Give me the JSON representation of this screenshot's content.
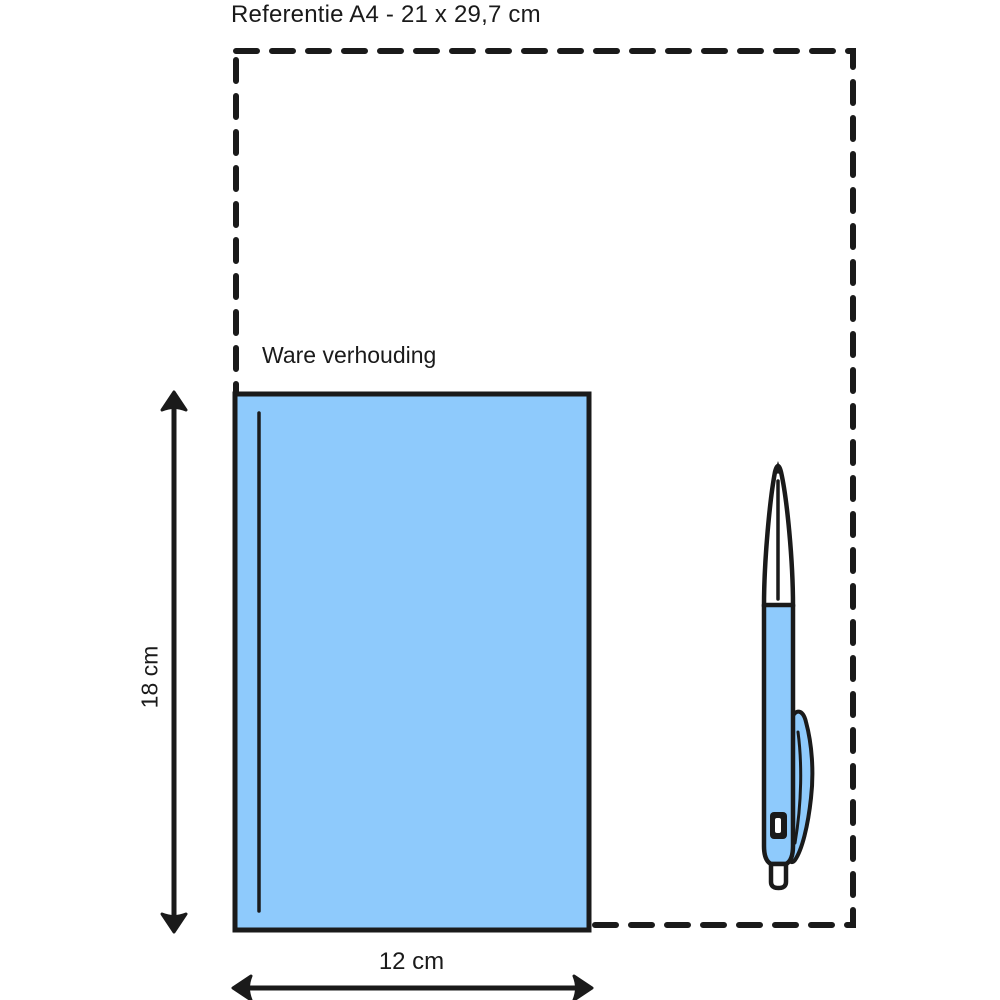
{
  "diagram": {
    "title": "Referentie A4 - 21 x 29,7 cm",
    "scale_label": "Ware verhouding",
    "height_label": "18 cm",
    "width_label": "12 cm",
    "reference": {
      "format": "A4",
      "width_cm": "21",
      "height_cm": "29,7"
    },
    "product": {
      "width_cm": "12",
      "height_cm": "18"
    },
    "colors": {
      "product_fill": "#8ecafc",
      "pen_fill": "#8ecafc",
      "outline": "#1a1a1a",
      "background": "#ffffff"
    }
  }
}
